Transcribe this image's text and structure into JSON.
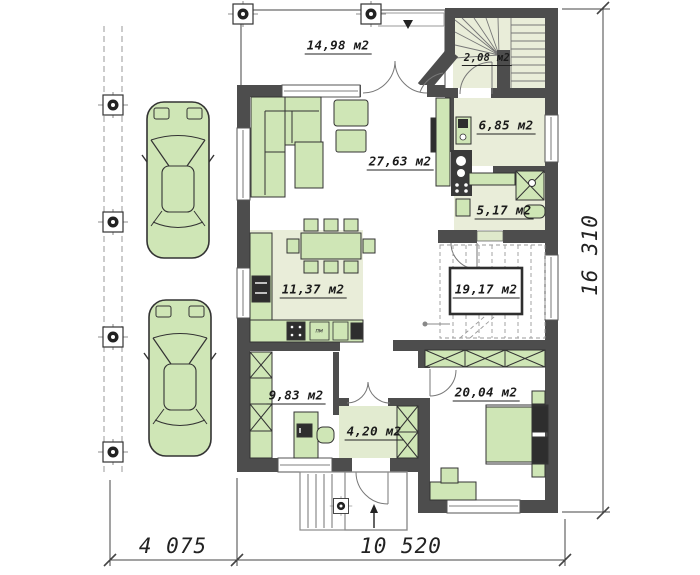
{
  "drawing_title": "ground-floor-plan",
  "rooms": {
    "terrace": {
      "area": "14,98 м2"
    },
    "stair_lobby": {
      "area": "2,08 м2"
    },
    "pantry": {
      "area": "6,85 м2"
    },
    "living_room": {
      "area": "27,63 м2"
    },
    "bathroom": {
      "area": "5,17 м2"
    },
    "kitchen": {
      "area": "11,37 м2"
    },
    "hall": {
      "area": "19,17 м2"
    },
    "office": {
      "area": "9,83 м2"
    },
    "entry": {
      "area": "4,20 м2"
    },
    "bedroom": {
      "area": "20,04 м2"
    }
  },
  "appliance_labels": {
    "dishwasher": "пм"
  },
  "dimensions": {
    "carport_width": "4 075",
    "house_width": "10 520",
    "house_depth": "16 310"
  },
  "colors": {
    "wall": "#4d4d4d",
    "furn": "#cfe6b6",
    "floor": "#e9edd9",
    "line": "#333333",
    "thin": "#8a8a8a"
  }
}
